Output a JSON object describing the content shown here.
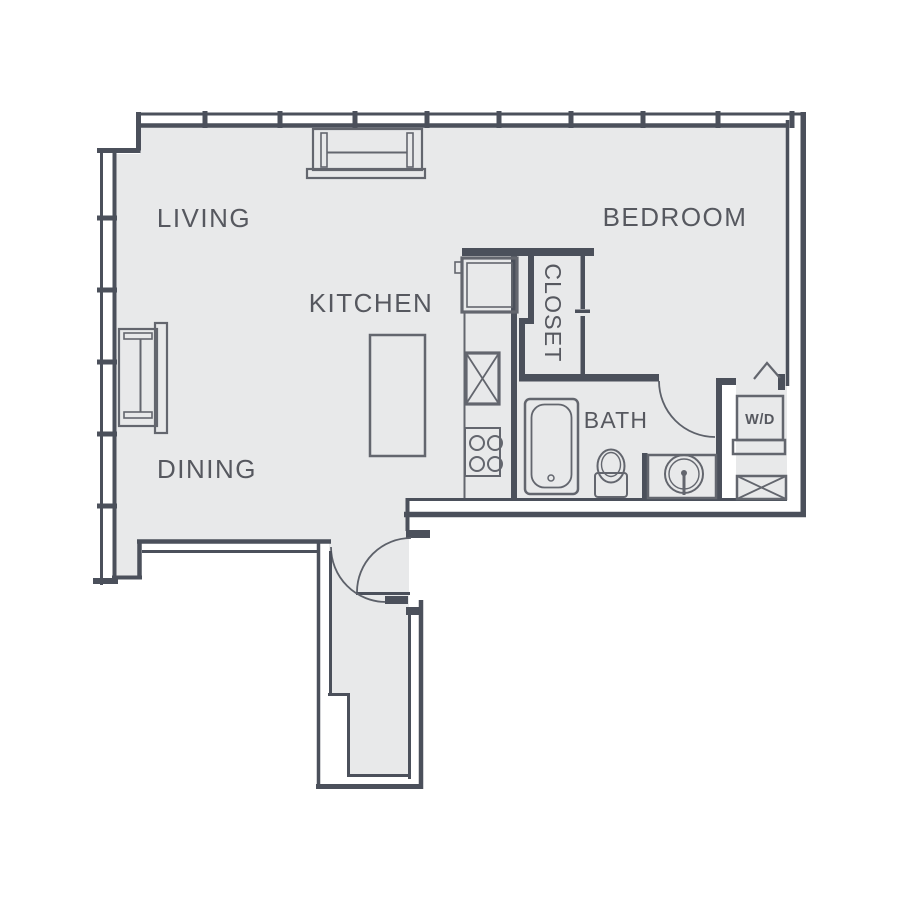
{
  "title": "One-bedroom apartment floor plan",
  "rooms": {
    "living": {
      "label": "LIVING"
    },
    "dining": {
      "label": "DINING"
    },
    "kitchen": {
      "label": "KITCHEN"
    },
    "closet": {
      "label": "CLOSET"
    },
    "bath": {
      "label": "BATH"
    },
    "bedroom": {
      "label": "BEDROOM"
    },
    "washer_dryer": {
      "label": "W/D"
    }
  },
  "colors": {
    "background": "#ffffff",
    "floor": "#e8e9ea",
    "wall": "#4b505b",
    "fixture_stroke": "#63666e",
    "text": "#56585f"
  }
}
